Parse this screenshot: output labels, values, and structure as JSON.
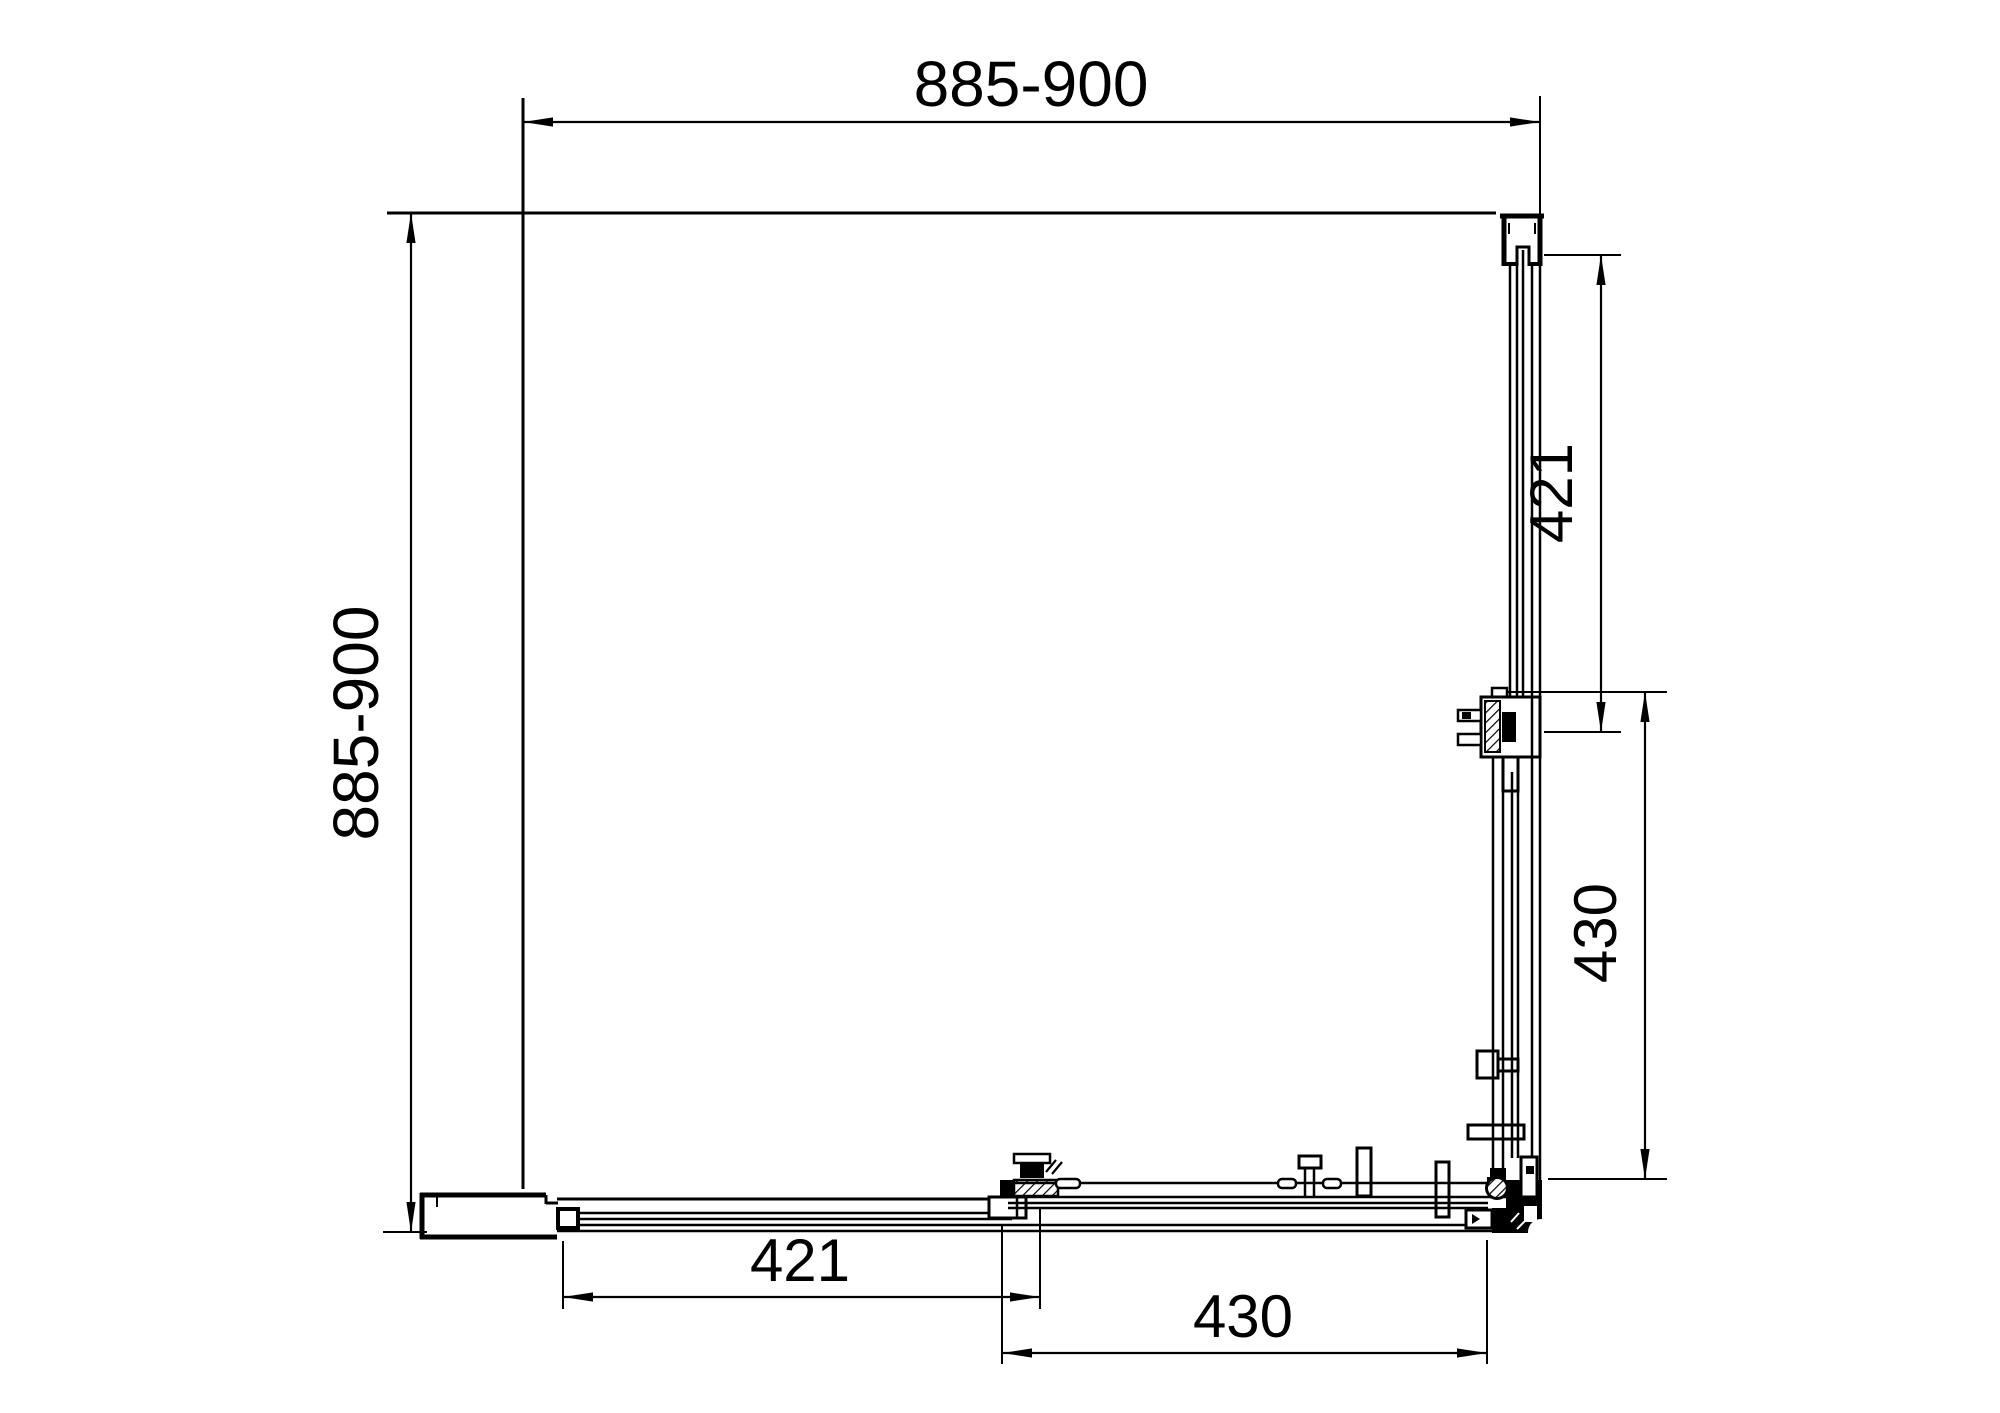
{
  "drawing": {
    "type": "technical-dimension-drawing",
    "subject": "Square corner-entry shower enclosure with two sliding doors, plan view",
    "units": "mm",
    "background_color": "#ffffff",
    "line_color": "#000000",
    "dims": {
      "top_width": "885-900",
      "left_height": "885-900",
      "right_fixed_panel": "421",
      "right_sliding_door": "430",
      "bottom_fixed_panel": "421",
      "bottom_sliding_door": "430"
    }
  }
}
